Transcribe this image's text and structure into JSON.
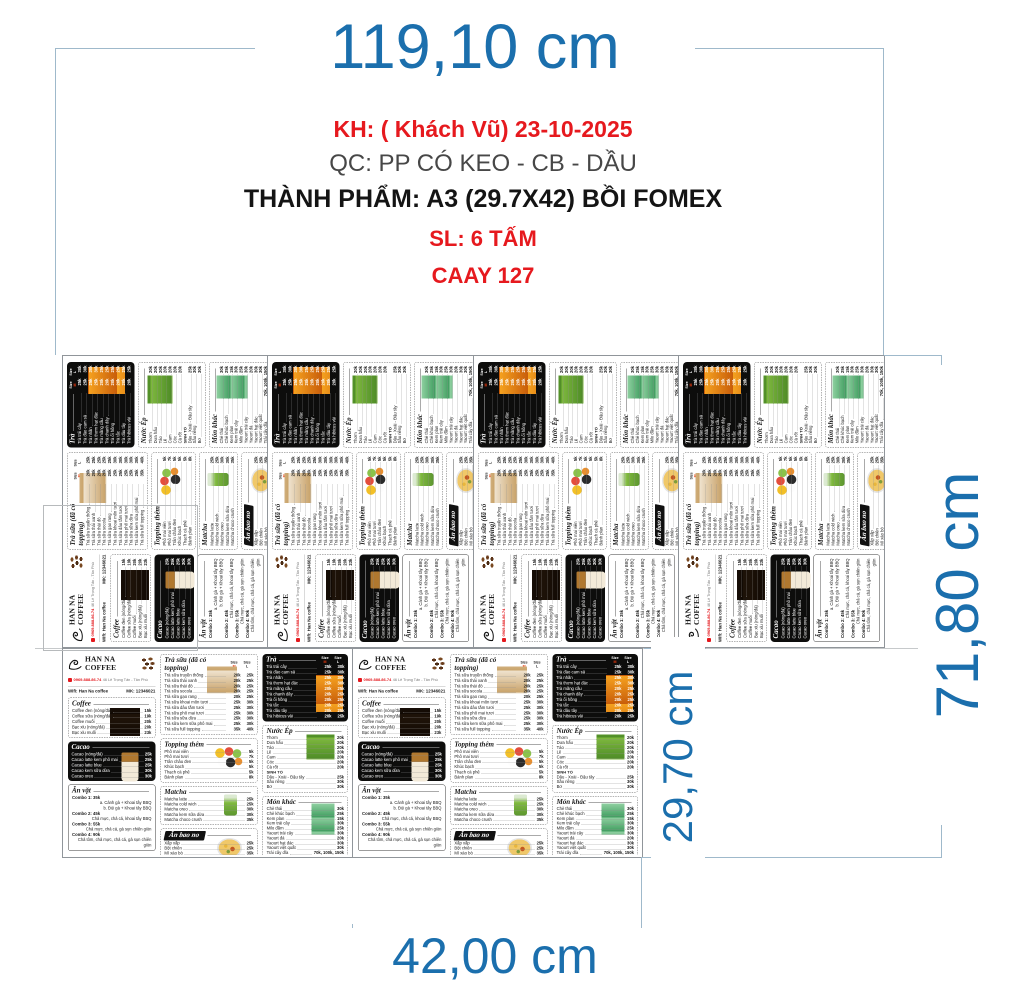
{
  "annotation": {
    "customer_line": "KH: ( Khách Vũ) 23-10-2025",
    "material_line": "QC: PP CÓ KEO - CB - DẦU",
    "product_line": "THÀNH PHẨM: A3  (29.7X42) BỒI FOMEX",
    "quantity_line": "SL: 6 TẤM",
    "code_line": "CAAY 127"
  },
  "dimensions": {
    "total_width": "119,10 cm",
    "total_height": "71,80 cm",
    "panel_height": "29,70 cm",
    "panel_width": "42,00 cm"
  },
  "colors": {
    "dimension_blue": "#1b6fad",
    "note_red": "#e6191e",
    "bracket_steel": "#9fb9cb",
    "menu_black": "#0d0d0c",
    "size_m_red": "#e8380d"
  },
  "layout": {
    "panels_top_row": 4,
    "panels_bottom_row": 2
  },
  "menu": {
    "brand": "HAN NA COFFEE",
    "phone": "0969.888.86.74",
    "address": "46 Lê Trọng Tấn - Tân Phú",
    "wifi": "Wifi: Han Na coffee",
    "password": "MK: 12346021",
    "size_label": "Size",
    "size_m": "M",
    "size_l": "L",
    "sections": {
      "coffee": {
        "title": "Coffee",
        "items": [
          [
            "Coffee đen (nóng/đá)",
            "15k"
          ],
          [
            "Coffee sữa (nóng/đá)",
            "19k"
          ],
          [
            "Coffee muối",
            "20k"
          ],
          [
            "Bạc xỉu (nóng/đá)",
            "20k"
          ],
          [
            "Bạc xỉu muối",
            "23k"
          ]
        ]
      },
      "cacao": {
        "title": "Cacao",
        "items": [
          [
            "Cacao (nóng/đá)",
            "25k"
          ],
          [
            "Cacao latte kem phô mai",
            "25k"
          ],
          [
            "Cacao latte blue",
            "25k"
          ],
          [
            "Cacao kem sữa dừa",
            "30k"
          ],
          [
            "Cacao oreo",
            "30k"
          ]
        ]
      },
      "an_vat": {
        "title": "Ăn vặt",
        "lines": [
          {
            "t": "l",
            "text": "Combo 1: 35k"
          },
          {
            "t": "d",
            "text": "a. Cánh gà + Khoai tây BBQ"
          },
          {
            "t": "d",
            "text": "b. Đùi gà + Khoai tây BBQ"
          },
          {
            "t": "l",
            "text": "Combo 2: 45k"
          },
          {
            "t": "d",
            "text": "Chả mực, chả cá, khoai tây BBQ"
          },
          {
            "t": "l",
            "text": "Combo 3: 55k"
          },
          {
            "t": "d",
            "text": "Chả mực, chả cá, gà sụn chiên giòn"
          },
          {
            "t": "l",
            "text": "Combo 4: 90k"
          },
          {
            "t": "d",
            "text": "Chả tôm, chả mực, chả cá, gà sụn chiên giòn"
          }
        ]
      },
      "tra_sua": {
        "title": "Trà sữa (đã có topping)",
        "items": [
          [
            "Trà sữa truyền thống",
            "20k",
            "25k"
          ],
          [
            "Trà sữa thái xanh",
            "20k",
            "25k"
          ],
          [
            "Trà sữa thái đỏ",
            "20k",
            "25k"
          ],
          [
            "Trà sữa socola",
            "20k",
            "25k"
          ],
          [
            "Trà sữa gạo rang",
            "20k",
            "25k"
          ],
          [
            "Trà sữa khoai môn tươi",
            "25k",
            "30k"
          ],
          [
            "Trà sữa dâu tằm tươi",
            "25k",
            "30k"
          ],
          [
            "Trà sữa phô mai tươi",
            "25k",
            "30k"
          ],
          [
            "Trà sữa sữa dừa",
            "25k",
            "30k"
          ],
          [
            "Trà sữa kem sữa phô mai",
            "25k",
            "30k"
          ],
          [
            "Trà sữa full topping",
            "35k",
            "40k"
          ]
        ]
      },
      "topping": {
        "title": "Topping thêm",
        "items": [
          [
            "Phô mai viên",
            "5k"
          ],
          [
            "Phô mai tươi",
            "7k"
          ],
          [
            "Trân châu đen",
            "5k"
          ],
          [
            "Khúc bạch",
            "5k"
          ],
          [
            "Thạch cà phê",
            "5k"
          ],
          [
            "Bánh plan",
            "8k"
          ]
        ]
      },
      "matcha": {
        "title": "Matcha",
        "items": [
          [
            "Matcha latte",
            "25k"
          ],
          [
            "Matcha cold wich",
            "25k"
          ],
          [
            "Matcha oreo",
            "30k"
          ],
          [
            "Matcha kem sữa dừa",
            "30k"
          ],
          [
            "Matcha choco crush",
            "35k"
          ]
        ]
      },
      "an_bao_no": {
        "title": "Ăn bao no",
        "items": [
          [
            "Xấp xấp",
            "25k"
          ],
          [
            "Bột chiên",
            "25k"
          ],
          [
            "Mì xào bò",
            "35k"
          ],
          [
            "Mì xào hải sản",
            "35k"
          ],
          [
            "Bánh tráng trộn",
            "15k"
          ]
        ]
      },
      "tra": {
        "title": "Trà",
        "items": [
          [
            "Trà trái cây",
            "25k",
            "30k"
          ],
          [
            "Trà đào cam sả",
            "25k",
            "30k"
          ],
          [
            "Trà nhãn",
            "25k",
            "30k"
          ],
          [
            "Trà thơm hạt đác",
            "25k",
            "30k"
          ],
          [
            "Trà mãng cầu",
            "20k",
            "25k"
          ],
          [
            "Trà chanh dây",
            "20k",
            "25k"
          ],
          [
            "Trà ổi hồng",
            "20k",
            "25k"
          ],
          [
            "Trà tắc",
            "20k",
            "25k"
          ],
          [
            "Trà dâu tây",
            "20k",
            "25k"
          ],
          [
            "Trà hibicus vải",
            "20k",
            "25k"
          ]
        ]
      },
      "nuoc_ep": {
        "title": "Nước Ép",
        "items": [
          [
            "Thơm",
            "20k"
          ],
          [
            "Dưa hấu",
            "20k"
          ],
          [
            "Táo",
            "20k"
          ],
          [
            "Lê",
            "20k"
          ],
          [
            "Cam",
            "20k"
          ],
          [
            "Cóc",
            "20k"
          ],
          [
            "Cà rốt",
            "20k"
          ],
          [
            "SINH TỐ"
          ],
          [
            "Dâu - Xoài - Đậu tây",
            "25k"
          ],
          [
            "Sầu riêng",
            "30k"
          ],
          [
            "Bơ",
            "30k"
          ]
        ]
      },
      "mon_khac": {
        "title": "Món khác",
        "items": [
          [
            "Chè thái",
            "30k"
          ],
          [
            "Chè khúc bạch",
            "25k"
          ],
          [
            "Kem plan",
            "15k"
          ],
          [
            "Kem trái cây",
            "30k"
          ],
          [
            "Milo đầm",
            "25k"
          ],
          [
            "Yaourt trái cây",
            "30k"
          ],
          [
            "Yaourt đá",
            "20k"
          ],
          [
            "Yaourt hạt đác",
            "30k"
          ],
          [
            "Yaourt việt quất",
            "30k"
          ],
          [
            "Trái cây dĩa",
            "70k, 100k, 150k"
          ]
        ]
      }
    }
  }
}
